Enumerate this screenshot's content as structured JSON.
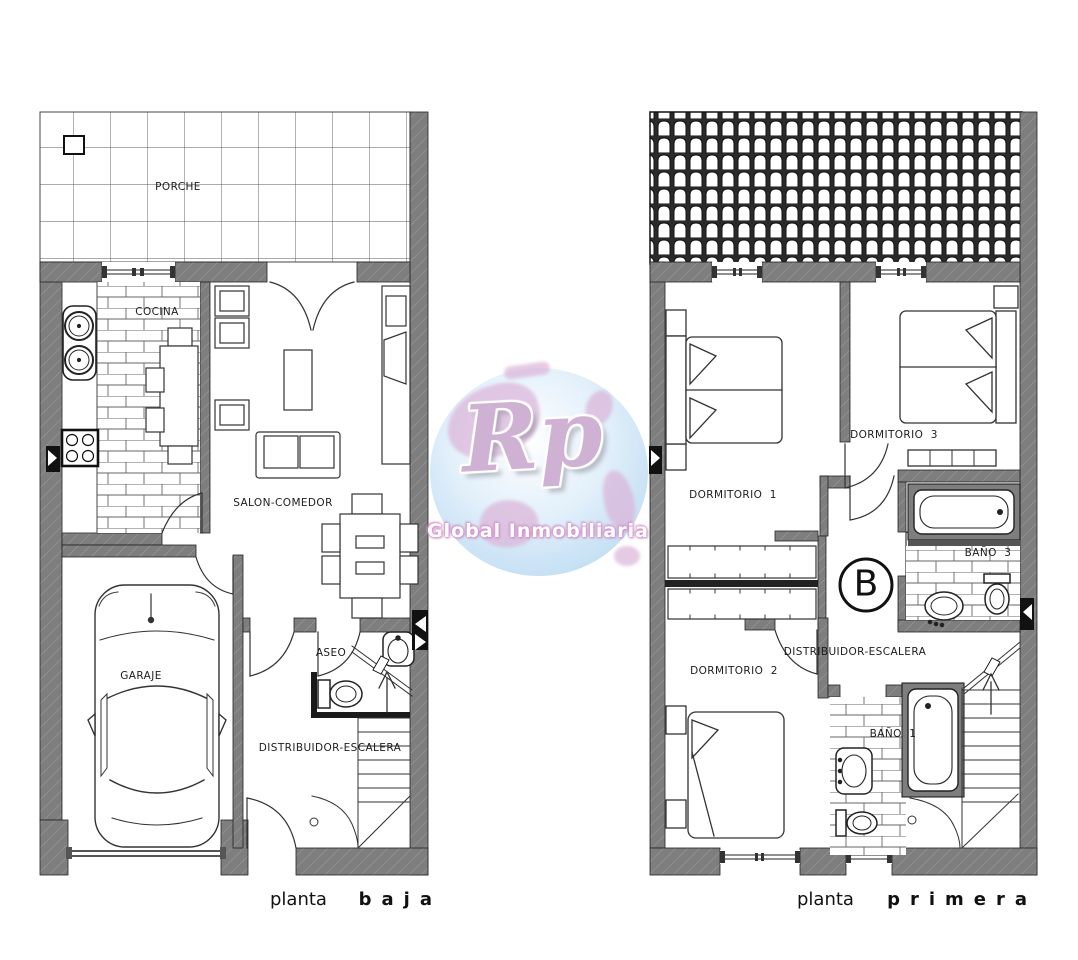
{
  "page": {
    "background": "#ffffff"
  },
  "watermark": {
    "initials": "Rp",
    "name": "Global Inmobiliaria",
    "colors": {
      "disc_blue": "#b7d9f1",
      "initials_pink": "#ccadd0",
      "name_white": "#ffffff",
      "accent_pink": "#d9aed6"
    }
  },
  "plans": {
    "ground": {
      "title_prefix": "planta",
      "title_name": "baja",
      "rooms": {
        "porche": "PORCHE",
        "cocina": "COCINA",
        "salon_comedor": "SALON-COMEDOR",
        "garaje": "GARAJE",
        "aseo": "ASEO",
        "distribuidor": "DISTRIBUIDOR-ESCALERA"
      }
    },
    "first": {
      "title_prefix": "planta",
      "title_name": "primera",
      "rooms": {
        "dormitorio_1": "DORMITORIO  1",
        "dormitorio_2": "DORMITORIO  2",
        "dormitorio_3": "DORMITORIO  3",
        "bano_1": "BAÑO  1",
        "bano_3": "BAÑO  3",
        "distribuidor": "DISTRIBUIDOR-ESCALERA",
        "stair_block_marker": "B"
      }
    }
  },
  "drawing_colors": {
    "wall_gray": "#7e7e7e",
    "line_dark": "#1a1a1a"
  }
}
